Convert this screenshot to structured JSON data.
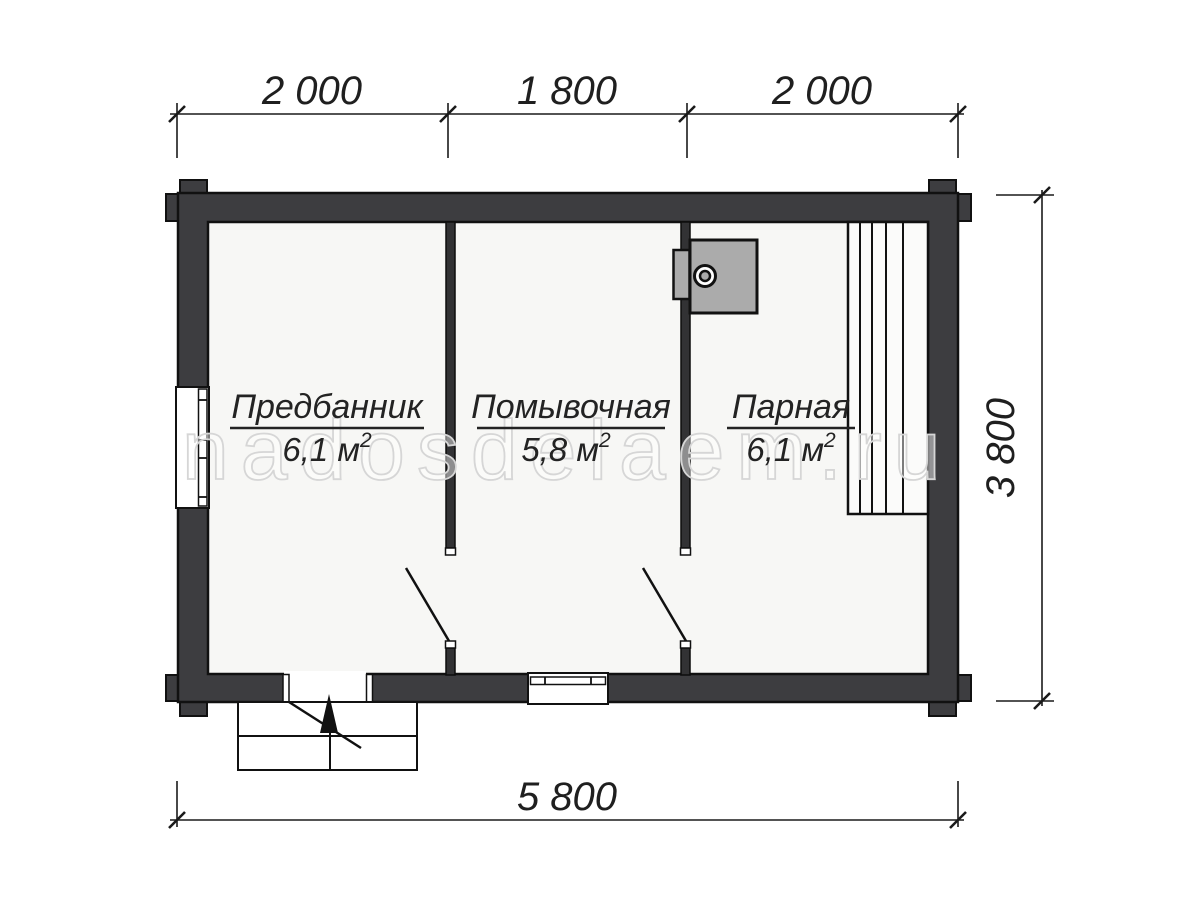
{
  "watermark": "nadosdelaem.ru",
  "plan": {
    "rooms": [
      {
        "name": "Предбанник",
        "area_text": "6,1 м",
        "area_sup": "2"
      },
      {
        "name": "Помывочная",
        "area_text": "5,8 м",
        "area_sup": "2"
      },
      {
        "name": "Парная",
        "area_text": "6,1 м",
        "area_sup": "2"
      }
    ],
    "dimensions": {
      "top": [
        "2 000",
        "1 800",
        "2 000"
      ],
      "right": "3 800",
      "bottom": "5 800"
    },
    "colors": {
      "wall": "#3d3d40",
      "outline": "#111111",
      "floor": "#f7f7f5",
      "stove": "#ababab",
      "dim_text": "#1f1f1f",
      "watermark_stroke": "#d6d6d6"
    }
  }
}
